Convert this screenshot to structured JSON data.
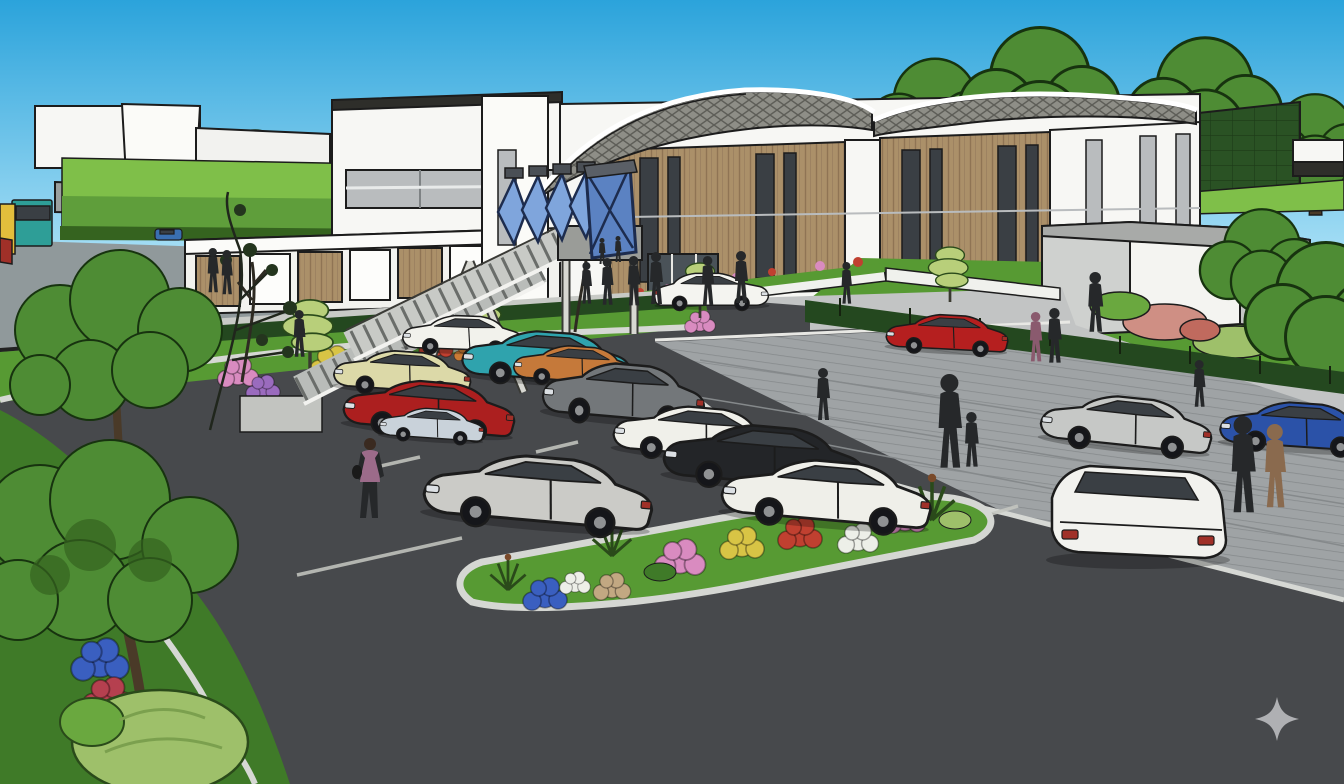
{
  "scene": {
    "type": "architectural-concept-rendering",
    "description": "Sketch-style 3D visualisation of a station park-and-ride: timber-clad building with wavy lattice canopies, blue glazed footbridge stairs, full car park, access road, landscaped flower beds and pedestrians",
    "landmarks": [
      "station building with two wave-form lattice canopies",
      "footbridge stair with blue angular glazing",
      "car park with marked bays",
      "oval flower-bed island",
      "access road with moving cars",
      "green living wall",
      "background houses and mature trees",
      "bus at far left"
    ],
    "watermark": "four-point sparkle, bottom right"
  },
  "colors": {
    "sky_top": "#2BA3DB",
    "sky_horizon": "#A9E0F6",
    "asphalt": "#47494C",
    "road_pavers": "#9FA3A5",
    "paver_line": "#85898B",
    "sidewalk": "#C2C4C4",
    "curb": "#D6D8D4",
    "grass": "#579A33",
    "grass_dark": "#3F7A28",
    "grass_light": "#7FBF49",
    "hedge": "#24481F",
    "tree_green": "#4E8C34",
    "tree_dark": "#35631F",
    "tree_light": "#B8CF7A",
    "trunk": "#4A3A28",
    "building_white": "#F7F7F4",
    "building_gray": "#CFD1CF",
    "window_band": "#B9BCBE",
    "wood": "#AB9069",
    "wood_line": "#8F7454",
    "canopy_mesh": "#8E8E87",
    "canopy_line": "#5E5E58",
    "green_wall": "#2A5224",
    "glass_blue": "#5B82C2",
    "glass_blue_light": "#7FA5DC",
    "glass_frame": "#1D2C4E",
    "window_dark": "#3A3F44",
    "outline": "#1C1C1C",
    "flower_pink": "#D98BC0",
    "flower_purple": "#9A6BBE",
    "flower_yellow": "#D8C445",
    "flower_red": "#C04030",
    "flower_orange": "#C97B35",
    "flower_white": "#EDEFE8",
    "flower_blue": "#3A5FC0",
    "flower_rose": "#B5404F",
    "bush_light": "#9EC06A",
    "person": "#26282A",
    "person_brown": "#8A6A4E",
    "person_top_purple": "#9C6B8A",
    "watermark": "#B9BABC"
  },
  "vehicles": {
    "bus": {
      "label": "bus at far left",
      "body": "#2E9E97",
      "front": "#E3BE3C"
    },
    "cars": [
      {
        "label": "white hatchback rear row",
        "color": "#F2F2EC"
      },
      {
        "label": "teal sedan",
        "color": "#2FA3AD"
      },
      {
        "label": "orange sedan",
        "color": "#C5793A"
      },
      {
        "label": "cream sedan",
        "color": "#DCD9A8"
      },
      {
        "label": "red sedan",
        "color": "#AC1F1F"
      },
      {
        "label": "pale blue compact",
        "color": "#C9D2DA"
      },
      {
        "label": "gray SUV",
        "color": "#73777A"
      },
      {
        "label": "silver sedan front left",
        "color": "#CBCBC7"
      },
      {
        "label": "white sedan middle",
        "color": "#F0F0EA"
      },
      {
        "label": "black sedan",
        "color": "#232528"
      },
      {
        "label": "white sedan front right",
        "color": "#EFEFE9"
      },
      {
        "label": "white car at entrance",
        "color": "#F4F4F0"
      },
      {
        "label": "red sports car on road",
        "color": "#B51F1F"
      },
      {
        "label": "silver sedan on road",
        "color": "#C6C8C6"
      },
      {
        "label": "blue coupe right edge",
        "color": "#2B52A8"
      },
      {
        "label": "white sedan rear view",
        "color": "#F2F2EE"
      },
      {
        "label": "small blue car distant",
        "color": "#3A6FB0"
      }
    ]
  },
  "people": [
    {
      "label": "woman walking in car park, purple top"
    },
    {
      "label": "group at station entrance",
      "count": 8
    },
    {
      "label": "adult holding child's hand"
    },
    {
      "label": "pedestrians on right footpath",
      "count": 5
    },
    {
      "label": "two walkers lower right, one in brown coat"
    },
    {
      "label": "figures near left building",
      "count": 3
    }
  ]
}
